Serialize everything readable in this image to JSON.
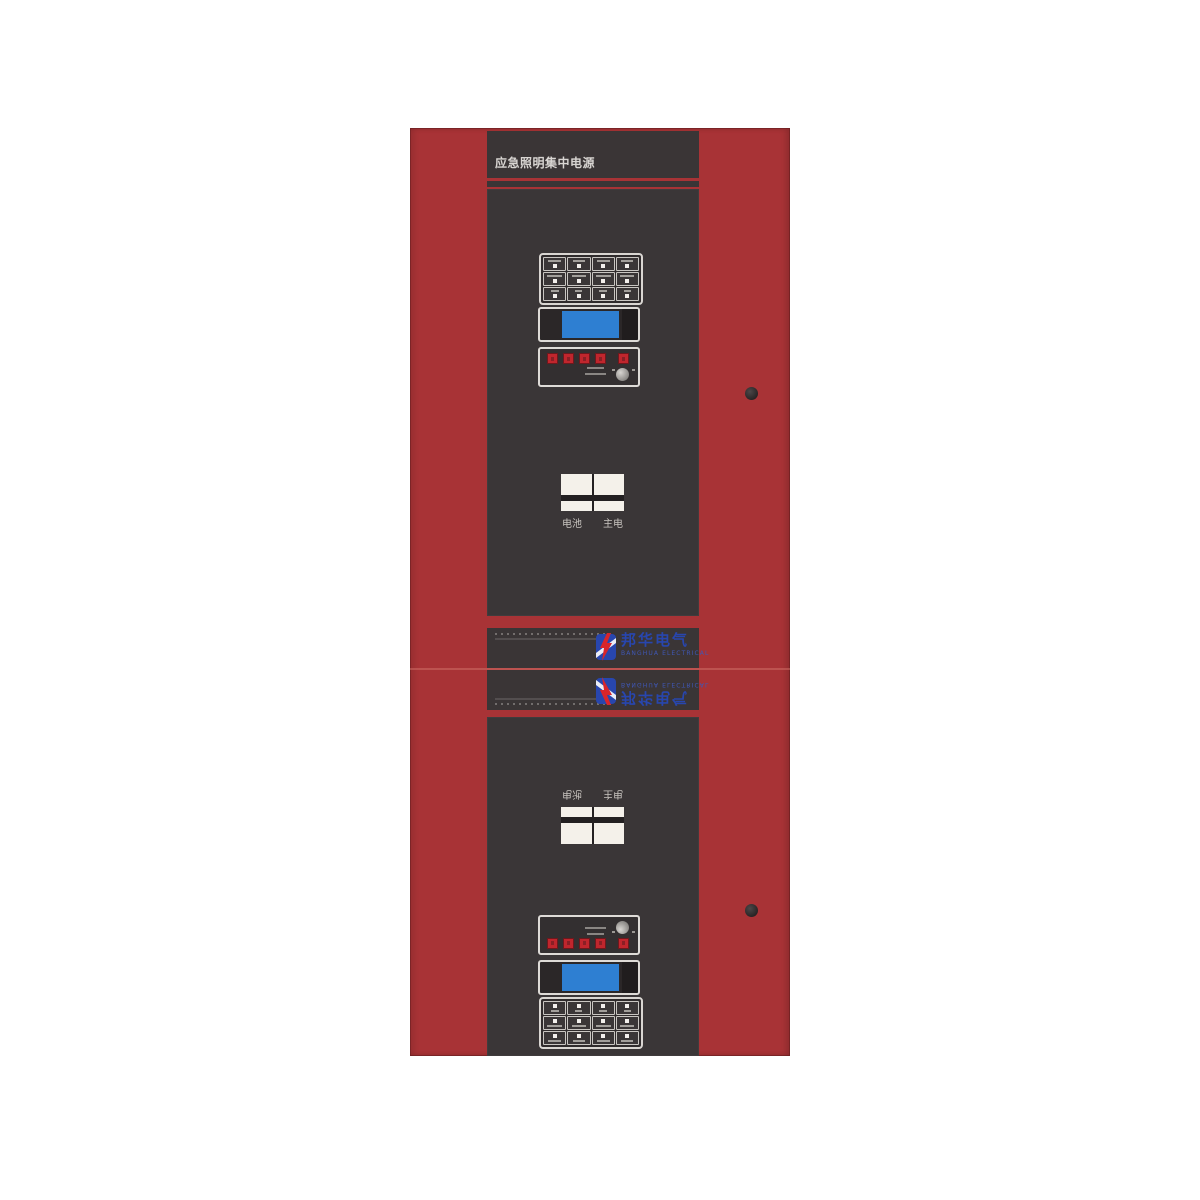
{
  "device": {
    "title": "应急照明集中电源",
    "logo": {
      "cn": "邦华电气",
      "en": "BANGHUA ELECTRICAL"
    },
    "rocker_switch_labels": {
      "left": "电池",
      "right": "主电"
    },
    "control_panels": {
      "button_grid": {
        "rows": 3,
        "cols": 4
      },
      "red_buttons": {
        "grouped": 4,
        "single": 1
      },
      "lcd": {
        "screen": "blank-blue"
      },
      "key_knob": true
    },
    "colors": {
      "cabinet_red": "#a83336",
      "panel_dark": "#3a3637",
      "band_dark": "#3a3536",
      "lcd_blue": "#2e7fd2",
      "logo_blue": "#2846ae",
      "bolt_red": "#d8252b",
      "button_red": "#c0262d"
    }
  }
}
